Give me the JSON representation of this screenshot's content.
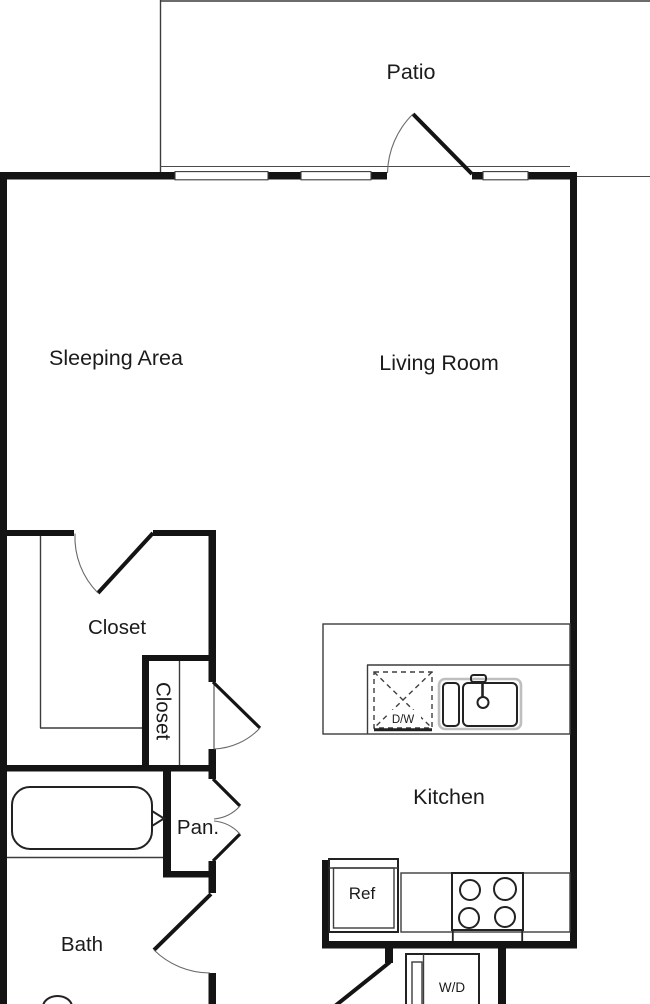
{
  "plan": {
    "type": "apartment-floor-plan",
    "rooms": {
      "patio": {
        "label": "Patio"
      },
      "sleeping_area": {
        "label": "Sleeping Area"
      },
      "living_room": {
        "label": "Living Room"
      },
      "closet_main": {
        "label": "Closet"
      },
      "closet_small": {
        "label": "Closet"
      },
      "pantry": {
        "label": "Pan."
      },
      "bath": {
        "label": "Bath"
      },
      "kitchen": {
        "label": "Kitchen"
      }
    },
    "fixtures": {
      "dishwasher": {
        "label": "D/W"
      },
      "refrigerator": {
        "label": "Ref"
      },
      "washer_dryer": {
        "label": "W/D"
      }
    },
    "colors": {
      "wall": "#141414",
      "line": "#3c3c3c",
      "label": "#1b1b1b",
      "fixture_halo": "#bfbfbf",
      "background": "#ffffff"
    }
  }
}
